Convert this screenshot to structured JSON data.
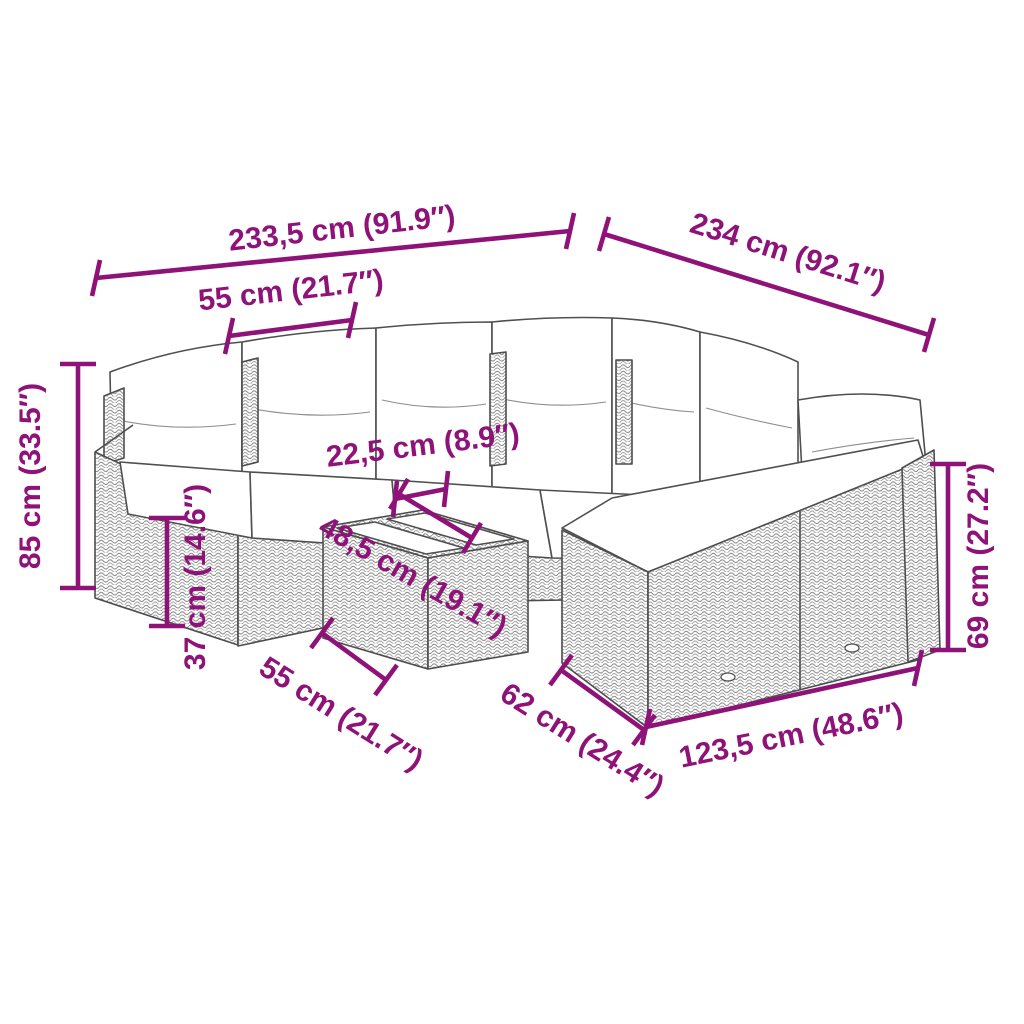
{
  "figure": {
    "type": "product-dimension-diagram",
    "subject": "modular rattan garden lounge set with cushions and tray table"
  },
  "colors": {
    "accent": "#8e1278",
    "outline": "#4d4d4d",
    "background": "#ffffff"
  },
  "labels": {
    "overall_width": "233,5 cm (91.9″)",
    "overall_depth": "234 cm (92.1″)",
    "seat_width": "55 cm (21.7″)",
    "overall_height": "85 cm (33.5″)",
    "tray_width": "22,5 cm (8.9″)",
    "table_depth": "48,5 cm (19.1″)",
    "seat_height": "37 cm (14.6″)",
    "table_width": "55 cm (21.7″)",
    "seat_depth": "62 cm (24.4″)",
    "front_section_width": "123,5 cm (48.6″)",
    "backrest_height": "69 cm (27.2″)"
  }
}
